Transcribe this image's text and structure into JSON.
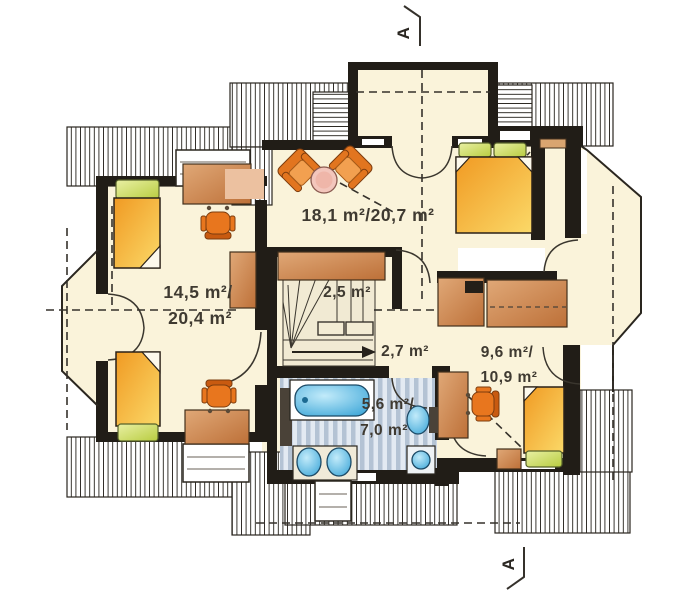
{
  "plan": {
    "type": "attic-floor-plan",
    "section_marker": "A",
    "labels": {
      "master": "18,1 m²/20,7 m²",
      "left1": "14,5 m²/",
      "left2": "20,4 m²",
      "stairs": "2,5 m²",
      "hall": "2,7 m²",
      "right1": "9,6 m²/",
      "right2": "10,9 m²",
      "bath1": "5,6 m²/",
      "bath2": "7,0 m²"
    },
    "rooms": [
      {
        "id": "master-bedroom",
        "area": "18,1 m²/20,7 m²",
        "features": [
          "balcony",
          "double-bed",
          "two-armchairs",
          "coffee-table",
          "wardrobe"
        ]
      },
      {
        "id": "left-bedroom",
        "area": "14,5 m²/20,4 m²",
        "features": [
          "two-single-beds",
          "two-desks",
          "two-chairs",
          "shelf",
          "bay-door"
        ]
      },
      {
        "id": "staircase",
        "area": "2,5 m²",
        "features": [
          "winder-stairs",
          "direction-arrow"
        ]
      },
      {
        "id": "hall",
        "area": "2,7 m²",
        "features": []
      },
      {
        "id": "right-bedroom",
        "area": "9,6 m²/10,9 m²",
        "features": [
          "single-bed",
          "desk",
          "chair",
          "dresser",
          "wardrobe"
        ]
      },
      {
        "id": "bathroom",
        "area": "5,6 m²/7,0 m²",
        "features": [
          "bathtub",
          "two-sinks",
          "toilet",
          "washing-machine"
        ]
      }
    ],
    "colors": {
      "floor_cream": "#faf3da",
      "wall_black": "#211d17",
      "bed_orange": "#f3a22e",
      "bed_yellow": "#fad660",
      "pillow_green": "#c6d554",
      "furniture_orange": "#e8761e",
      "wood_brown": "#c9854f",
      "table_pink": "#f3c6bc",
      "fixture_blue": "#5bc8ee",
      "bath_floor_stripe": "#b9c6d6"
    }
  }
}
